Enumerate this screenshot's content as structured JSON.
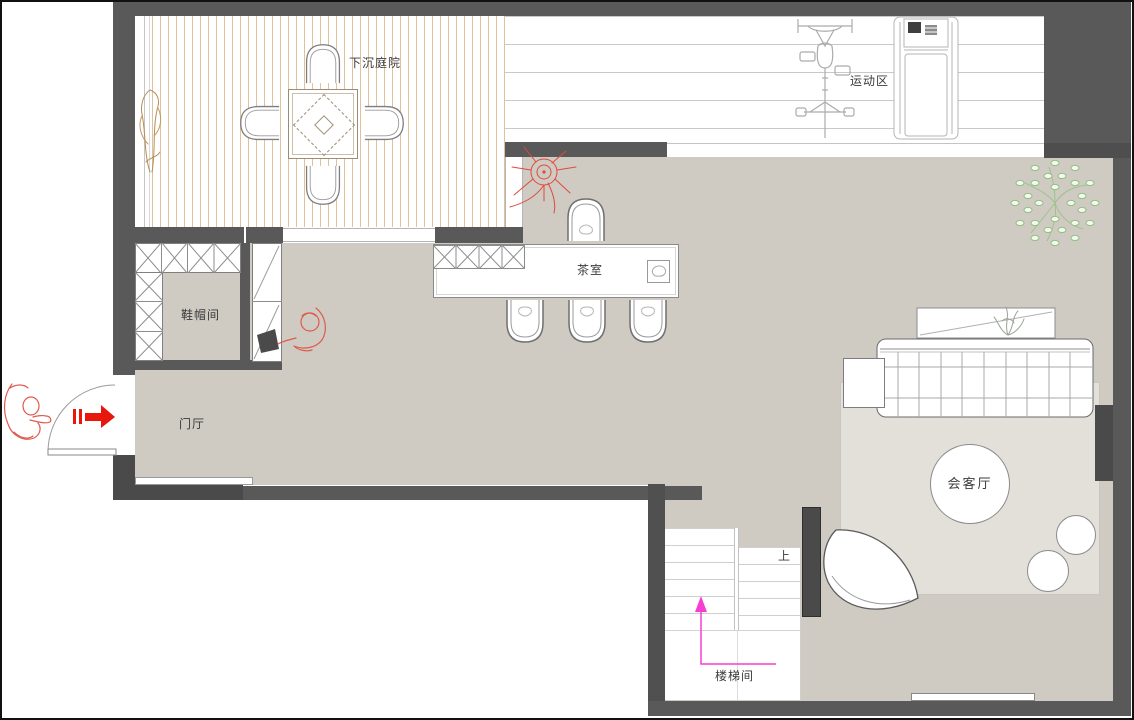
{
  "rooms": {
    "sunken_courtyard": {
      "label": "下沉庭院"
    },
    "exercise_area": {
      "label": "运动区"
    },
    "cloakroom": {
      "label": "鞋帽间"
    },
    "foyer": {
      "label": "门厅"
    },
    "tea_room": {
      "label": "茶室"
    },
    "reception_room": {
      "label": "会客厅"
    },
    "stairwell": {
      "label": "楼梯间"
    }
  },
  "annotations": {
    "stairs_up": "上"
  },
  "colors": {
    "wall": "#595959",
    "wall_dark": "#4a4a4a",
    "floor": "#cfcbc3",
    "rug": "#e3e0da",
    "plank_line": "#dfc19c",
    "board_line": "#c9c9c9",
    "entry_arrow_red": "#e8170d",
    "sketch_red": "#dd5a4c",
    "stair_path_magenta": "#f63fd0",
    "tree_green": "#8fbf7f"
  }
}
